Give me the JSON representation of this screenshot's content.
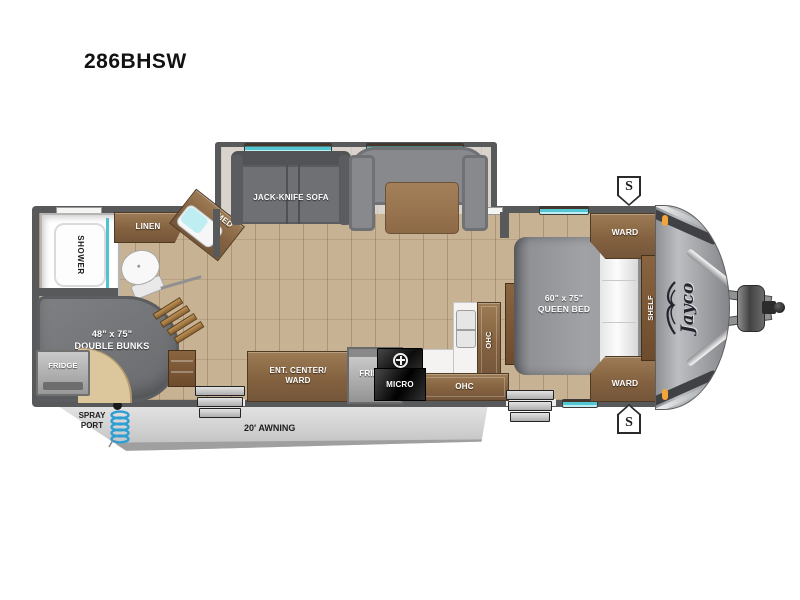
{
  "title": "286BHSW",
  "brand": {
    "logo_text": "Jayco"
  },
  "exterior": {
    "awning_label": "20' AWNING",
    "spray_port_line1": "SPRAY",
    "spray_port_line2": "PORT",
    "speaker_symbol": "S"
  },
  "bathroom": {
    "shower": "SHOWER",
    "linen": "LINEN",
    "med": "MED"
  },
  "bunk_room": {
    "size": "48\" x 75\"",
    "name": "DOUBLE BUNKS",
    "fridge": "FRIDGE"
  },
  "living": {
    "sofa": "JACK-KNIFE SOFA"
  },
  "kitchen": {
    "ent_center_line1": "ENT. CENTER/",
    "ent_center_line2": "WARD",
    "fridge": "FRIDGE",
    "micro": "MICRO",
    "ohc_upper": "OHC",
    "ohc_lower": "OHC"
  },
  "bedroom": {
    "size": "60\" x 75\"",
    "name": "QUEEN BED",
    "ward_top": "WARD",
    "ward_bottom": "WARD",
    "shelf": "SHELF"
  },
  "colors": {
    "wall": "#58595b",
    "floor_wood": "#c8b294",
    "cabinet_wood": "#8a6a4a",
    "window_teal": "#52c6d2",
    "awning_gray": "#d8d8d8",
    "marker_orange": "#f5a43a",
    "hose_blue": "#2e9fd4",
    "front_cap_gray": "#a5a7aa"
  }
}
